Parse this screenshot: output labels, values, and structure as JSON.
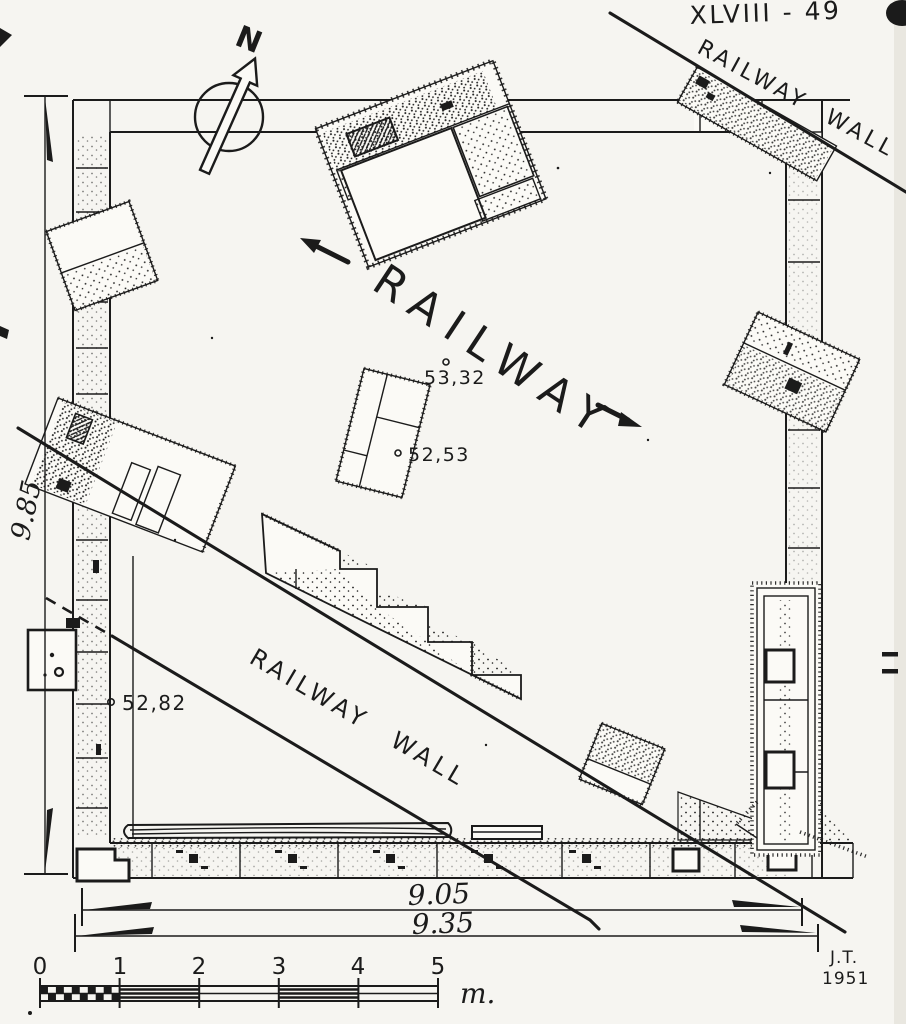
{
  "plate": {
    "number": "XLVIII - 49"
  },
  "compass": {
    "north": "N"
  },
  "labels": {
    "railway": "RAILWAY",
    "railway_wall_top": "RAILWAY WALL",
    "railway_wall_mid": "RAILWAY WALL"
  },
  "spot_heights": {
    "upper": "53,32",
    "middle": "52,53",
    "lower": "52,82"
  },
  "dimensions": {
    "left": "9.85",
    "bottom_inner": "9.05",
    "bottom_outer": "9.35"
  },
  "scale_bar": {
    "t0": "0",
    "t1": "1",
    "t2": "2",
    "t3": "3",
    "t4": "4",
    "t5": "5",
    "unit": "m."
  },
  "signature": {
    "initials": "J.T.",
    "year": "1951"
  },
  "colors": {
    "ink": "#1b1b1b",
    "paper": "#f6f5f1"
  }
}
